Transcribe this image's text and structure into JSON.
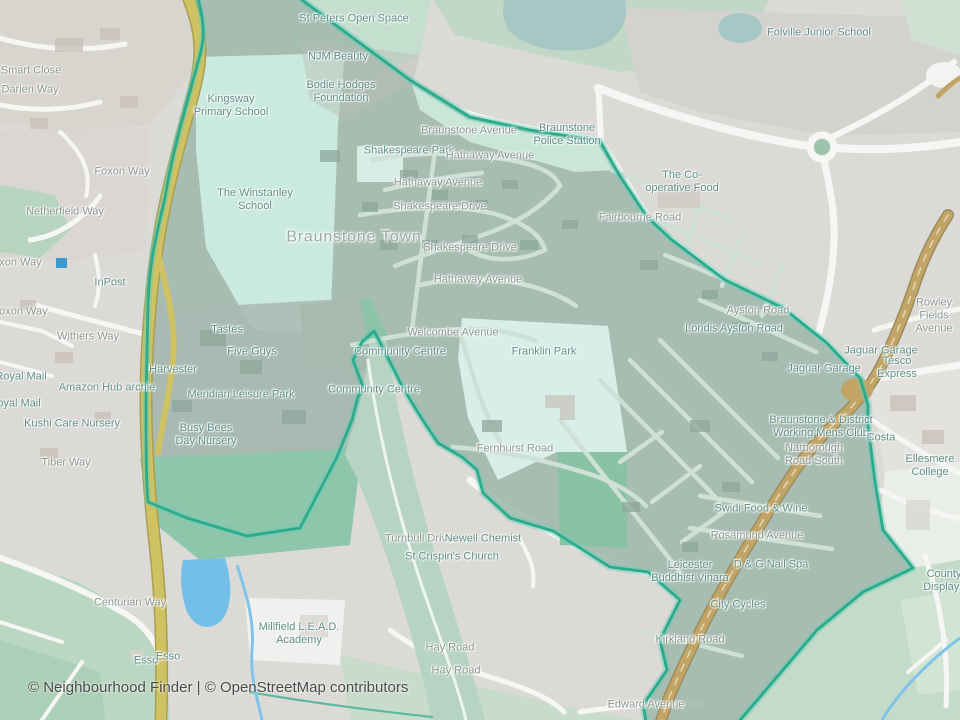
{
  "map": {
    "attribution": "© Neighbourhood Finder | © OpenStreetMap contributors",
    "colors": {
      "boundary": "#29ab8f",
      "boundary_halo": "#6cc9ad",
      "neighbourhood_fill": "#a2b9ae",
      "motorway": "#cfc263",
      "primary_road": "#c2a566",
      "water_bright": "#74bfe8",
      "water_muted": "#a6c8c4",
      "park_mint": "#d7efe8",
      "school_mint": "#cbeadf",
      "field_green": "#8ec6ab",
      "road_label": "#8b9791",
      "poi_label": "#5f8f88"
    },
    "labels": [
      {
        "text": "Smart Close",
        "x": 31,
        "y": 71,
        "t": "road"
      },
      {
        "text": "Darien Way",
        "x": 30,
        "y": 90,
        "t": "road"
      },
      {
        "text": "Foxon Way",
        "x": 122,
        "y": 172,
        "t": "road"
      },
      {
        "text": "Netherfield Way",
        "x": 65,
        "y": 212,
        "t": "road"
      },
      {
        "text": "Foxon Way",
        "x": 14,
        "y": 263,
        "t": "road"
      },
      {
        "text": "Foxon Way",
        "x": 20,
        "y": 312,
        "t": "road"
      },
      {
        "text": "InPost",
        "x": 110,
        "y": 283,
        "t": "poi"
      },
      {
        "text": "Withers Way",
        "x": 88,
        "y": 337,
        "t": "road"
      },
      {
        "text": "Royal Mail",
        "x": 21,
        "y": 377,
        "t": "poi"
      },
      {
        "text": "Royal Mail",
        "x": 15,
        "y": 404,
        "t": "poi"
      },
      {
        "text": "Amazon Hub archie",
        "x": 107,
        "y": 388,
        "t": "poi"
      },
      {
        "text": "Kushi Care Nursery",
        "x": 72,
        "y": 424,
        "t": "poi"
      },
      {
        "text": "Tiber Way",
        "x": 66,
        "y": 463,
        "t": "road"
      },
      {
        "text": "St Peters Open Space",
        "x": 354,
        "y": 19,
        "t": "poi"
      },
      {
        "text": "NJM Beauty",
        "x": 338,
        "y": 57,
        "t": "poi"
      },
      {
        "text": "Bodie Hodges\nFoundation",
        "x": 341,
        "y": 92,
        "t": "poi"
      },
      {
        "text": "Kingsway\nPrimary School",
        "x": 231,
        "y": 106,
        "t": "poi"
      },
      {
        "text": "The Winstanley\nSchool",
        "x": 255,
        "y": 200,
        "t": "poi"
      },
      {
        "text": "Braunstone Avenue",
        "x": 469,
        "y": 131,
        "t": "road"
      },
      {
        "text": "Braunstone\nPolice Station",
        "x": 567,
        "y": 135,
        "t": "poi"
      },
      {
        "text": "Folville Junior School",
        "x": 819,
        "y": 33,
        "t": "poi"
      },
      {
        "text": "Shakespeare Park",
        "x": 409,
        "y": 151,
        "t": "poi"
      },
      {
        "text": "Hathaway Avenue",
        "x": 490,
        "y": 156,
        "t": "road"
      },
      {
        "text": "Hathaway Avenue",
        "x": 438,
        "y": 183,
        "t": "road"
      },
      {
        "text": "Shakespeare Drive",
        "x": 440,
        "y": 207,
        "t": "road"
      },
      {
        "text": "Shakespeare Drive",
        "x": 470,
        "y": 248,
        "t": "road"
      },
      {
        "text": "Hathaway Avenue",
        "x": 478,
        "y": 280,
        "t": "road"
      },
      {
        "text": "The Co-\noperative Food",
        "x": 682,
        "y": 182,
        "t": "poi"
      },
      {
        "text": "Fairbourne Road",
        "x": 640,
        "y": 218,
        "t": "road"
      },
      {
        "text": "Braunstone Town",
        "x": 354,
        "y": 238,
        "t": "place"
      },
      {
        "text": "Tastes",
        "x": 227,
        "y": 330,
        "t": "poi"
      },
      {
        "text": "Five Guys",
        "x": 252,
        "y": 352,
        "t": "poi"
      },
      {
        "text": "Harvester",
        "x": 173,
        "y": 370,
        "t": "poi"
      },
      {
        "text": "Meridian Leisure Park",
        "x": 241,
        "y": 395,
        "t": "poi"
      },
      {
        "text": "Busy Bees\nDay Nursery",
        "x": 206,
        "y": 435,
        "t": "poi"
      },
      {
        "text": "Welcombe Avenue",
        "x": 453,
        "y": 333,
        "t": "road"
      },
      {
        "text": "Community Centre",
        "x": 400,
        "y": 352,
        "t": "poi"
      },
      {
        "text": "Community Centre",
        "x": 374,
        "y": 390,
        "t": "poi"
      },
      {
        "text": "Franklin Park",
        "x": 544,
        "y": 352,
        "t": "poi"
      },
      {
        "text": "Ayston Road",
        "x": 758,
        "y": 311,
        "t": "road"
      },
      {
        "text": "Londis Ayston Road",
        "x": 734,
        "y": 329,
        "t": "poi"
      },
      {
        "text": "Rowley Fields Avenue",
        "x": 934,
        "y": 316,
        "t": "road"
      },
      {
        "text": "Jaguar Garage",
        "x": 881,
        "y": 351,
        "t": "poi"
      },
      {
        "text": "Jaguar Garage",
        "x": 824,
        "y": 369,
        "t": "poi"
      },
      {
        "text": "Tesco Express",
        "x": 897,
        "y": 368,
        "t": "poi"
      },
      {
        "text": "Braunstone & District\nWorking Mens Club",
        "x": 821,
        "y": 427,
        "t": "poi"
      },
      {
        "text": "Costa",
        "x": 881,
        "y": 438,
        "t": "poi"
      },
      {
        "text": "Narborough\nRoad South",
        "x": 814,
        "y": 455,
        "t": "road"
      },
      {
        "text": "Ellesmere College",
        "x": 930,
        "y": 466,
        "t": "poi"
      },
      {
        "text": "Fernhurst Road",
        "x": 515,
        "y": 449,
        "t": "road"
      },
      {
        "text": "Swidi Food & Wine",
        "x": 761,
        "y": 509,
        "t": "poi"
      },
      {
        "text": "Rosamund Avenue",
        "x": 757,
        "y": 536,
        "t": "road"
      },
      {
        "text": "D & G Nail Spa",
        "x": 771,
        "y": 565,
        "t": "poi"
      },
      {
        "text": "Leicester\nBuddhist Vihara",
        "x": 690,
        "y": 572,
        "t": "poi"
      },
      {
        "text": "City Cycles",
        "x": 738,
        "y": 605,
        "t": "poi"
      },
      {
        "text": "County Displays",
        "x": 944,
        "y": 581,
        "t": "poi"
      },
      {
        "text": "Turnbull Drive",
        "x": 419,
        "y": 539,
        "t": "road"
      },
      {
        "text": "Newell Chemist",
        "x": 483,
        "y": 539,
        "t": "poi"
      },
      {
        "text": "St Crispin's Church",
        "x": 452,
        "y": 557,
        "t": "poi"
      },
      {
        "text": "Millfield L.E.A.D.\nAcademy",
        "x": 299,
        "y": 634,
        "t": "poi"
      },
      {
        "text": "Centurian Way",
        "x": 130,
        "y": 603,
        "t": "road"
      },
      {
        "text": "Esso",
        "x": 146,
        "y": 661,
        "t": "poi"
      },
      {
        "text": "Esso",
        "x": 168,
        "y": 657,
        "t": "poi"
      },
      {
        "text": "Hay Road",
        "x": 450,
        "y": 648,
        "t": "road"
      },
      {
        "text": "Hay Road",
        "x": 456,
        "y": 671,
        "t": "road"
      },
      {
        "text": "Kirkland Road",
        "x": 690,
        "y": 640,
        "t": "road"
      },
      {
        "text": "Edward Avenue",
        "x": 646,
        "y": 705,
        "t": "road"
      }
    ]
  }
}
